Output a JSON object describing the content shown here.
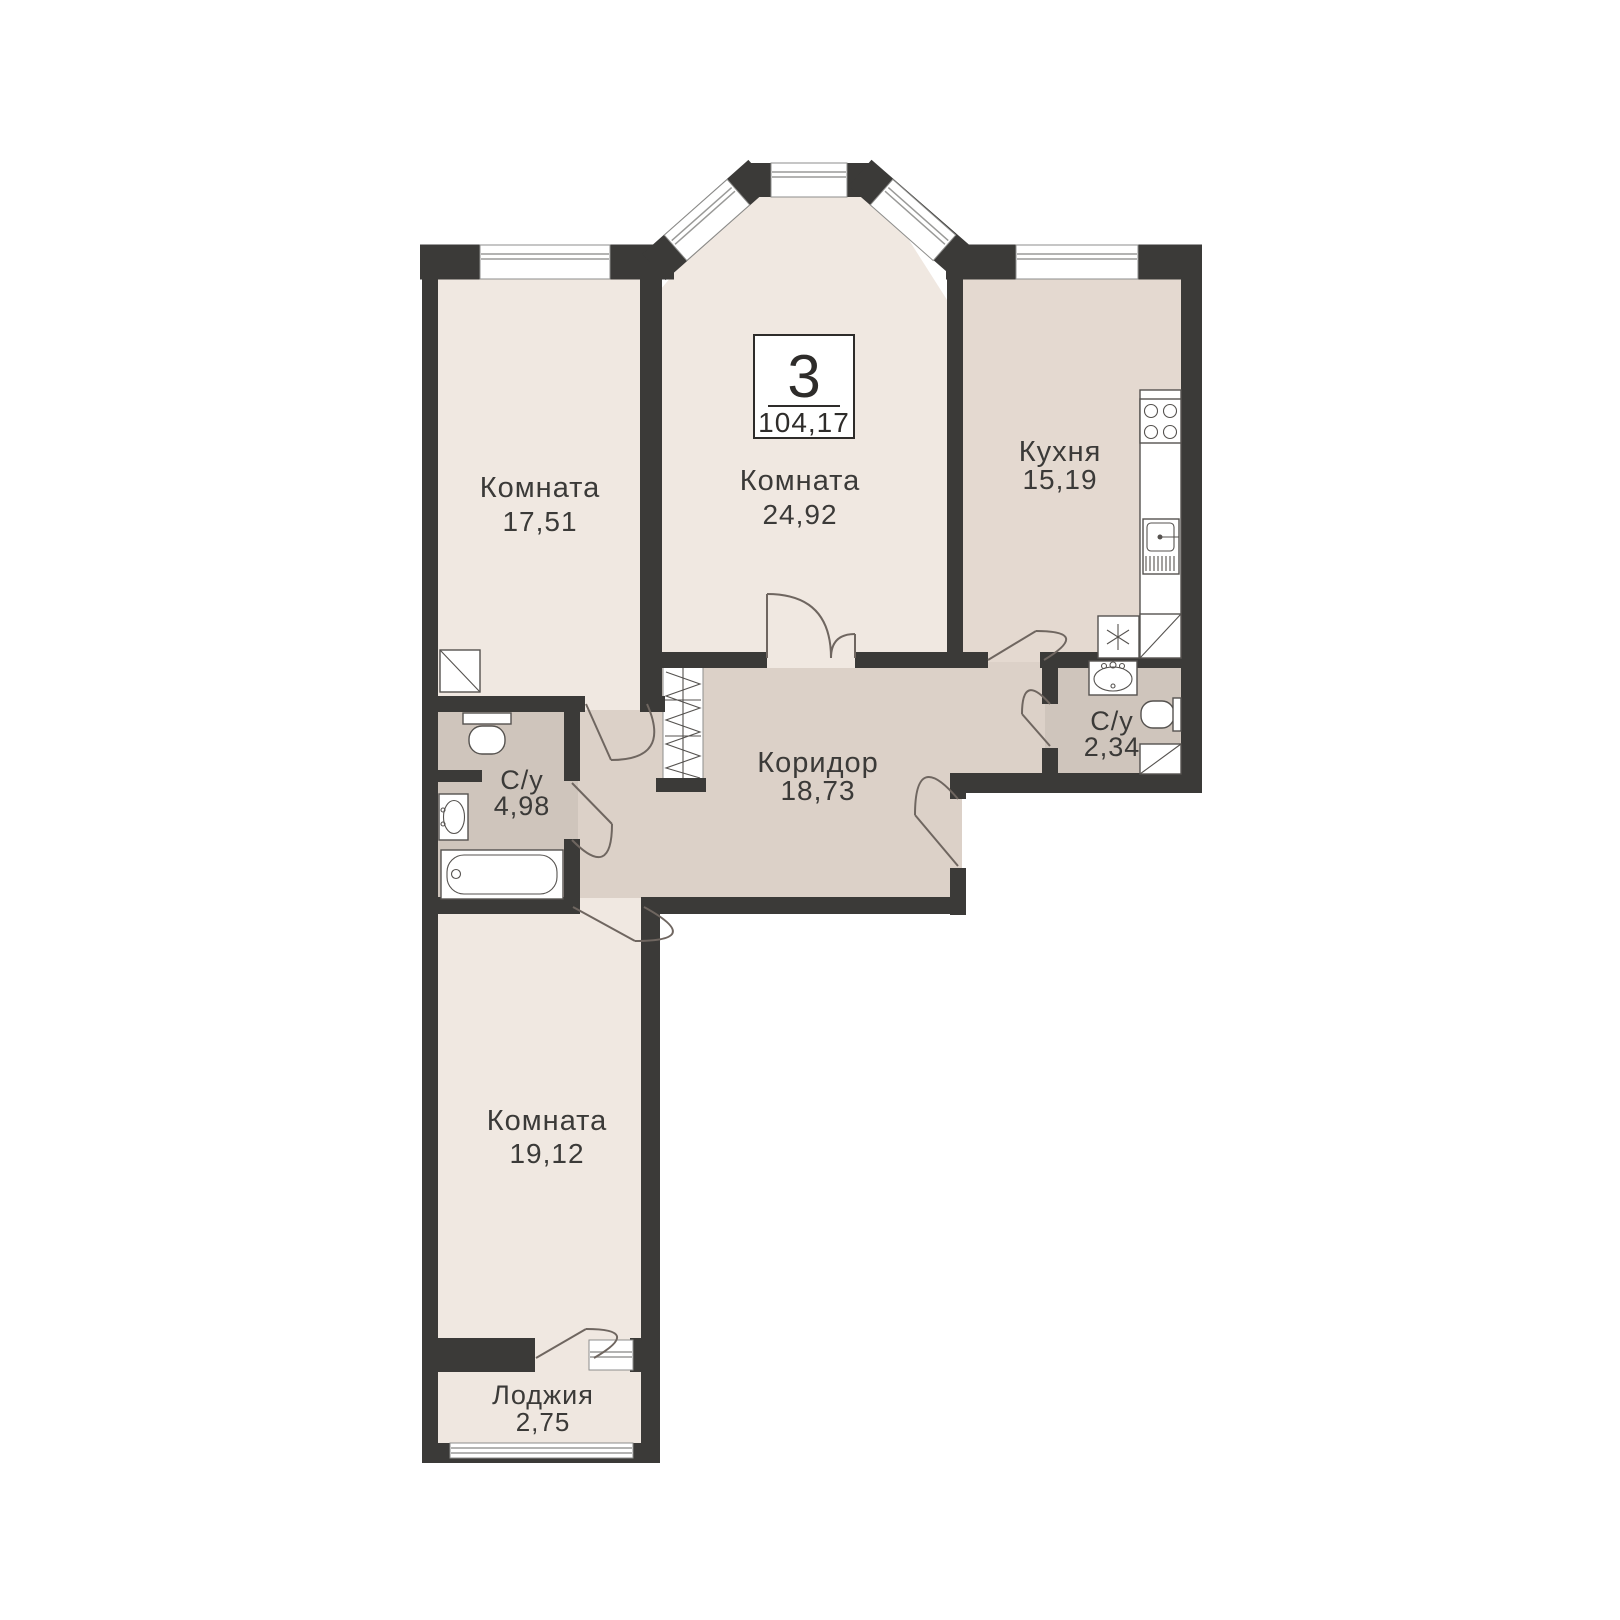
{
  "plan": {
    "badge": {
      "rooms_count": "3",
      "total_area": "104,17"
    },
    "rooms": [
      {
        "key": "room-1",
        "name": "Комната",
        "area": "17,51"
      },
      {
        "key": "room-2",
        "name": "Комната",
        "area": "24,92"
      },
      {
        "key": "kitchen",
        "name": "Кухня",
        "area": "15,19"
      },
      {
        "key": "corridor",
        "name": "Коридор",
        "area": "18,73"
      },
      {
        "key": "bathroom-1",
        "name": "С/у",
        "area": "4,98"
      },
      {
        "key": "bathroom-2",
        "name": "С/у",
        "area": "2,34"
      },
      {
        "key": "room-3",
        "name": "Комната",
        "area": "19,12"
      },
      {
        "key": "loggia",
        "name": "Лоджия",
        "area": "2,75"
      }
    ],
    "colors": {
      "wall": "#3b3a38",
      "room_fill": "#f0e8e1",
      "kitchen_fill": "#e4d9d0",
      "corridor_fill": "#dcd1c8",
      "bathroom_fill": "#cfc5bc",
      "loggia_fill": "#efe7e0",
      "window_fill": "#ffffff",
      "label_text": "#3b3a38"
    },
    "fixtures": [
      "stove-icon",
      "kitchen-sink-icon",
      "fridge-icon",
      "vent-shaft-icon",
      "toilet-icon",
      "washbasin-icon",
      "bathtub-icon",
      "wardrobe-icon",
      "window-icon",
      "door-swing-icon"
    ]
  }
}
